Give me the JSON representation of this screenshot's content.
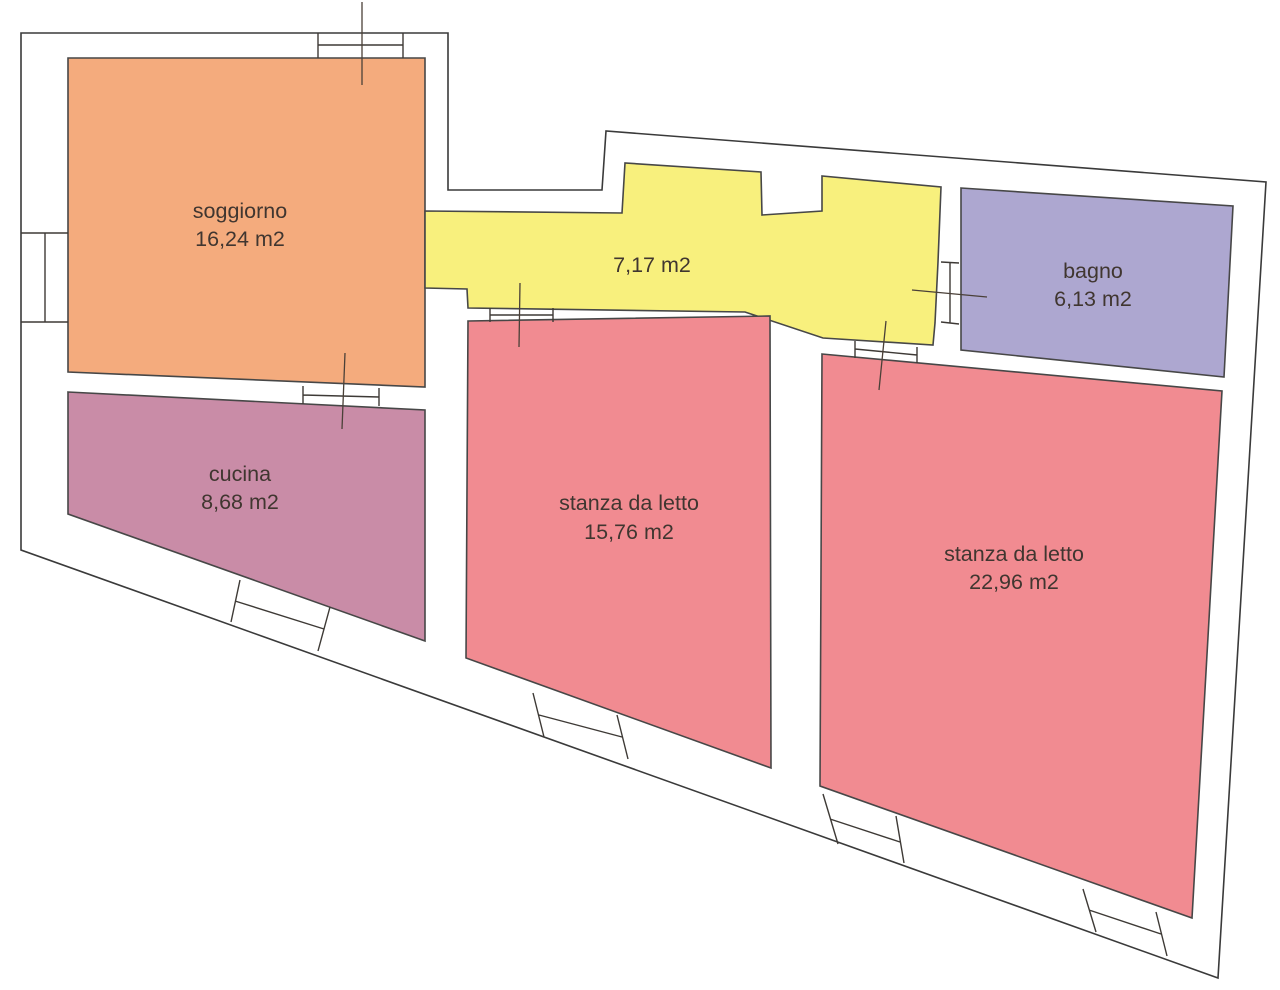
{
  "floor_plan": {
    "rooms": [
      {
        "id": "soggiorno",
        "label": "soggiorno",
        "area": "16,24 m2",
        "color": "#f4ab7d"
      },
      {
        "id": "cucina",
        "label": "cucina",
        "area": "8,68 m2",
        "color": "#c98ca7"
      },
      {
        "id": "bedroom-1",
        "label": "stanza da letto",
        "area": "15,76 m2",
        "color": "#f18b91"
      },
      {
        "id": "bedroom-2",
        "label": "stanza da letto",
        "area": "22,96 m2",
        "color": "#f18b91"
      },
      {
        "id": "bagno",
        "label": "bagno",
        "area": "6,13 m2",
        "color": "#ada7d0"
      },
      {
        "id": "corridor",
        "label": "",
        "area": "7,17 m2",
        "color": "#f8f07d"
      }
    ],
    "colors": {
      "outline": "#3a3a3a",
      "wall_fill": "#ffffff",
      "label_text": "#403630"
    }
  }
}
